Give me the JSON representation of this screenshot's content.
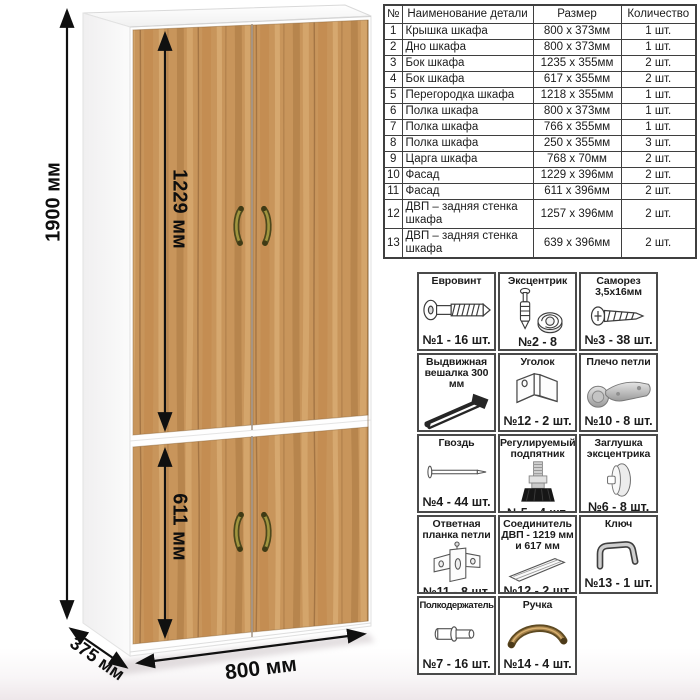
{
  "drawing": {
    "dims": {
      "height": "1900 мм",
      "upper_door": "1229 мм",
      "lower_door": "611 мм",
      "width": "800 мм",
      "depth": "375 мм"
    },
    "colors": {
      "wood": "#c8955b",
      "wood_dark": "#8c5f35",
      "wood_light": "#dcb178",
      "carcass": "#ffffff",
      "handle_bronze": "#6e5526",
      "dimension_line": "#101010",
      "table_border": "#3f3f3f"
    }
  },
  "parts_table": {
    "headers": [
      "№",
      "Наименование детали",
      "Размер",
      "Количество"
    ],
    "rows": [
      {
        "num": "1",
        "name": "Крышка шкафа",
        "size": "800 х 373мм",
        "qty": "1 шт."
      },
      {
        "num": "2",
        "name": "Дно шкафа",
        "size": "800 х 373мм",
        "qty": "1 шт."
      },
      {
        "num": "3",
        "name": "Бок шкафа",
        "size": "1235 х 355мм",
        "qty": "2 шт."
      },
      {
        "num": "4",
        "name": "Бок шкафа",
        "size": "617 х 355мм",
        "qty": "2 шт."
      },
      {
        "num": "5",
        "name": "Перегородка шкафа",
        "size": "1218 х 355мм",
        "qty": "1 шт."
      },
      {
        "num": "6",
        "name": "Полка шкафа",
        "size": "800 х 373мм",
        "qty": "1 шт."
      },
      {
        "num": "7",
        "name": "Полка шкафа",
        "size": "766 х 355мм",
        "qty": "1 шт."
      },
      {
        "num": "8",
        "name": "Полка шкафа",
        "size": "250 х 355мм",
        "qty": "3 шт."
      },
      {
        "num": "9",
        "name": "Царга шкафа",
        "size": "768 х 70мм",
        "qty": "2 шт."
      },
      {
        "num": "10",
        "name": "Фасад",
        "size": "1229 х 396мм",
        "qty": "2 шт."
      },
      {
        "num": "11",
        "name": "Фасад",
        "size": "611 х 396мм",
        "qty": "2 шт."
      },
      {
        "num": "12",
        "name": "ДВП – задняя стенка шкафа",
        "size": "1257 х 396мм",
        "qty": "2 шт."
      },
      {
        "num": "13",
        "name": "ДВП – задняя стенка шкафа",
        "size": "639 х 396мм",
        "qty": "2 шт."
      }
    ]
  },
  "hardware": {
    "items": [
      {
        "title": "Евровинт",
        "qty": "№1 - 16 шт.",
        "icon": "euro-screw-icon"
      },
      {
        "title": "Эксцентрик",
        "qty": "№2 - 8 комп.",
        "icon": "eccentric-cam-icon"
      },
      {
        "title": "Саморез 3,5х16мм",
        "qty": "№3 - 38 шт.",
        "icon": "self-tapping-screw-icon"
      },
      {
        "title": "Выдвижная вешалка 300 мм",
        "qty": "№10 - 1 шт.",
        "icon": "pull-out-hanger-icon"
      },
      {
        "title": "Уголок",
        "qty": "№12 - 2 шт.",
        "icon": "corner-bracket-icon"
      },
      {
        "title": "Плечо петли",
        "qty": "№10 - 8 шт.",
        "icon": "hinge-arm-icon"
      },
      {
        "title": "Гвоздь",
        "qty": "№4 - 44 шт.",
        "icon": "nail-icon"
      },
      {
        "title": "Регулируемый подпятник",
        "qty": "№5 - 4 шт.",
        "icon": "adjustable-foot-icon"
      },
      {
        "title": "Заглушка эксцентрика",
        "qty": "№6 - 8 шт.",
        "icon": "cam-cap-icon"
      },
      {
        "title": "Ответная планка петли",
        "qty": "№11 - 8 шт.",
        "icon": "hinge-mounting-plate-icon"
      },
      {
        "title": "Соединитель ДВП - 1219 мм и 617 мм",
        "qty": "№12 - 2 шт.",
        "icon": "hdf-connector-icon"
      },
      {
        "title": "Ключ",
        "qty": "№13 - 1 шт.",
        "icon": "hex-key-icon"
      },
      {
        "title": "Полкодержатель",
        "qty": "№7 - 16 шт.",
        "icon": "shelf-pin-icon"
      },
      {
        "title": "Ручка",
        "qty": "№14 - 4 шт.",
        "icon": "bow-handle-icon"
      }
    ]
  }
}
